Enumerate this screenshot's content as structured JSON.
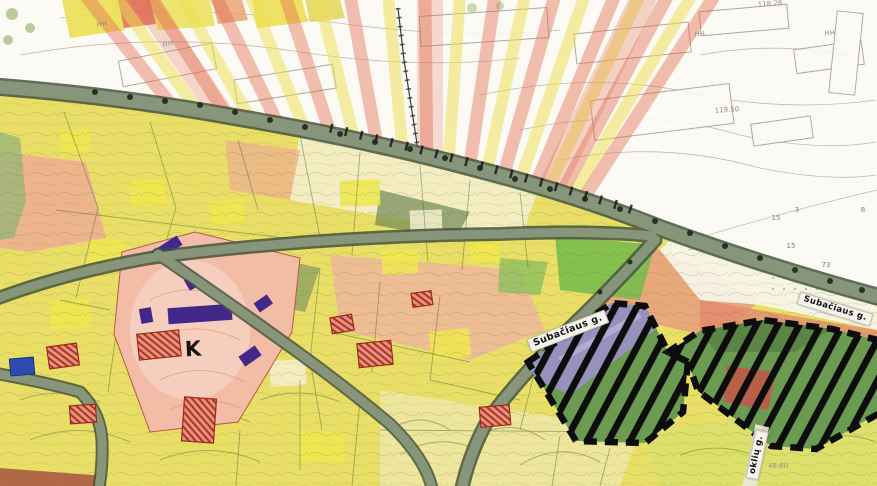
{
  "map_title": "Scanned urban heritage zoning map",
  "street_labels": {
    "center": "Subačiaus g.",
    "east": "Subačiaus g.",
    "south_vertical": "oklių g."
  },
  "zone_marks": {
    "district_letter": "K"
  },
  "elevation_marks": {
    "top_right": "118.28",
    "upper_right": "119.50",
    "bottom_right": "48.60"
  },
  "building_height_marks": {
    "m1": "HH",
    "m2": "HH",
    "m3": "HH",
    "m4": "HH"
  },
  "parcel_numbers": {
    "n1": "3",
    "n2": "15",
    "n3": "15",
    "n4": "73",
    "n5": "8"
  },
  "colors": {
    "paper": "#f6f3e8",
    "paper_top": "#fbfaf4",
    "parcel_yellow": "#eadf66",
    "parcel_cream": "#f3edc6",
    "parcel_pink": "#efb79c",
    "monument_pink": "#f2bca6",
    "monument_purple": "#43288c",
    "road_fill": "#87967b",
    "road_edge": "#44543c",
    "bright_green": "#7abb4b",
    "restricted_green": "#6b9b51",
    "restricted_lavender": "#9a90c3",
    "restricted_red": "#c05948",
    "ray_red": "#e26a4d",
    "ray_yellow": "#eedd4e",
    "building_red": "#c7402c",
    "building_blue": "#2e4ab0",
    "hatch_black": "#0d0d0d"
  }
}
